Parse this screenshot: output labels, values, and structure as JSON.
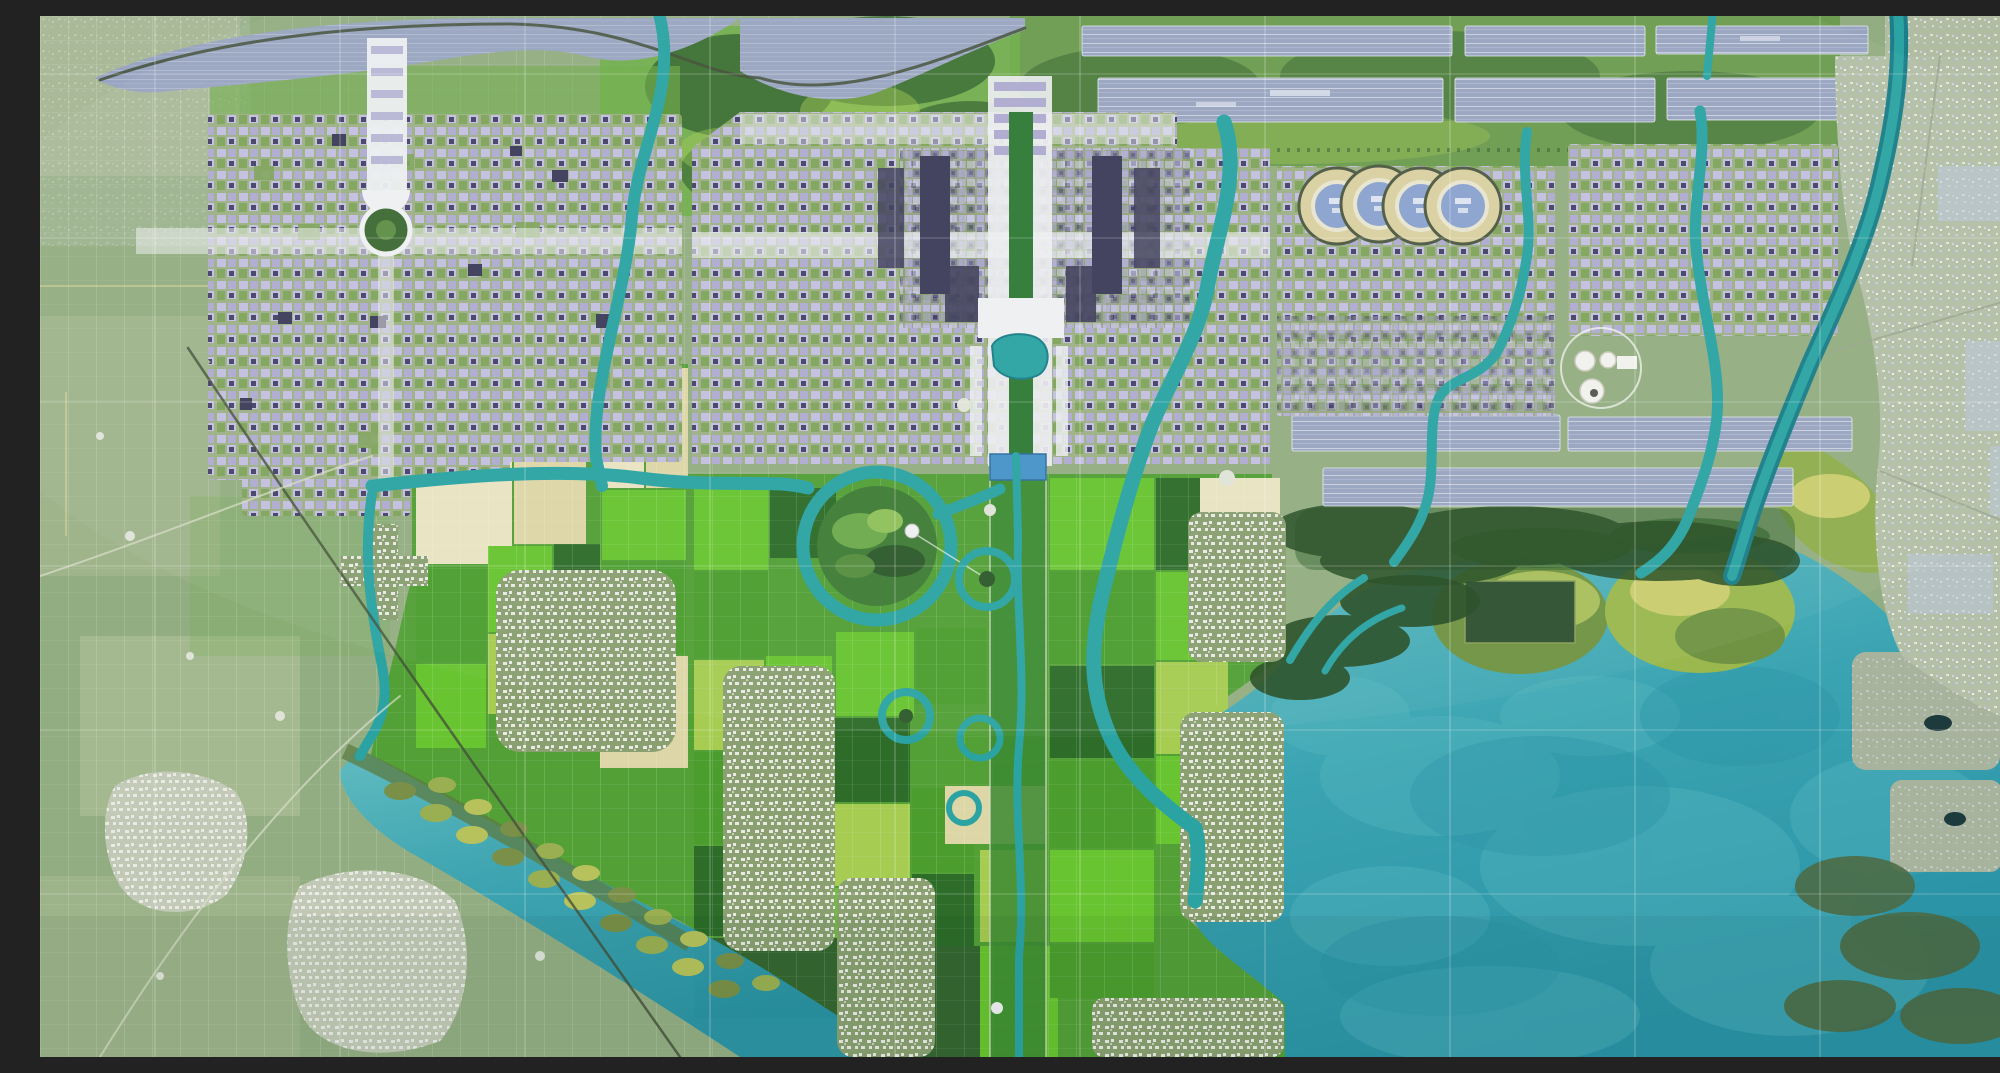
{
  "meta": {
    "title": "Aerial master-plan rendering of a planned new city with central axis, canal network, farmland mosaic and lake",
    "kind": "satellite-masterplan-image",
    "width_px": 2000,
    "height_px": 1041,
    "visible_text": "none"
  },
  "palette": {
    "base_green": "#93ad82",
    "rural_pale": "#b7c49e",
    "park_green": "#6fae49",
    "forest": "#35662f",
    "forest_dark": "#274e24",
    "marsh_olive": "#5d7c42",
    "field_bright": "#68c430",
    "field_mid": "#4b9e2e",
    "field_dark": "#2d6c29",
    "field_yellow": "#a6cc52",
    "field_tan": "#ddd6a6",
    "field_paletan": "#e9e3c2",
    "river": "#2ba3a3",
    "river_dark": "#1b7e89",
    "canal_blue": "#4693c9",
    "lake_light": "#5fbcc2",
    "lake_mid": "#3ba4b2",
    "lake_deep": "#2a93a6",
    "solar_base": "#98a4c0",
    "solar_stripe": "#c9d0e0",
    "solar_stripe2": "#aab3cb",
    "reservoir": "#9aa6c1",
    "city_base": "#9eb086",
    "city_block": "#c2bfe0",
    "city_block2": "#aeabd0",
    "city_green": "#7fa45c",
    "city_dark": "#45446a",
    "navy": "#3e3d5a",
    "axis_white": "#eef0f2",
    "village_base": "#8aa070",
    "speck_white": "#e9eae4",
    "excity_base": "#b3bfa6",
    "excity_speck": "#dfe3da",
    "excity_blue": "#bcc8da",
    "ring_band": "#d9d0a2",
    "ring_inner": "#8aa3cf",
    "tank_white": "#f1f1ee",
    "road_dark": "#43503a",
    "road_light": "#d9dec9",
    "gridline": "#ffffff"
  },
  "features": {
    "four_ring_stadiums": {
      "count": 4
    },
    "tank_facility": {
      "tank_count": 3
    },
    "axis_park_islands": {
      "count": 5
    },
    "comb_wetland_island_rows": 2,
    "north_solar_array_rows": 2,
    "east_solar_array_rows": 2
  },
  "regions": [
    {
      "id": "reservoir-canal-band",
      "name": "striped blue-gray reservoir band along the top"
    },
    {
      "id": "north-solar-arrays",
      "name": "two rows of striped solar/panel bands, top right"
    },
    {
      "id": "east-solar-arrays",
      "name": "two rows of striped solar/panel bands, mid right"
    },
    {
      "id": "northwest-city-grid",
      "name": "north-west lavender city grid with white cross axis and circular park"
    },
    {
      "id": "central-city-grid",
      "name": "central city grid with white north-south axis"
    },
    {
      "id": "axis-plaza-lake",
      "name": "white plaza and heart-shaped lake on the central axis"
    },
    {
      "id": "east-city-grid",
      "name": "city grid east of the central river"
    },
    {
      "id": "far-east-city-grid",
      "name": "far eastern city grid"
    },
    {
      "id": "four-ring-stadiums",
      "name": "four interlocking ring-shaped venues"
    },
    {
      "id": "tank-facility",
      "name": "circular utility facility with white tanks"
    },
    {
      "id": "northeast-greenbelt",
      "name": "green belt with tree rows, north-east"
    },
    {
      "id": "central-farmland-mosaic",
      "name": "bright patchwork farmland south of the city"
    },
    {
      "id": "axis-park-islands",
      "name": "ring-shaped park islands along the southern axis"
    },
    {
      "id": "big-ring-island",
      "name": "large wooded island encircled by a river"
    },
    {
      "id": "satellite-towns",
      "name": "gray satellite town clusters in the farmland"
    },
    {
      "id": "village-clusters",
      "name": "rural village patches, lower left"
    },
    {
      "id": "west-rural-farmland",
      "name": "muted rural field grid, west"
    },
    {
      "id": "comb-wetland-islands",
      "name": "diagonal comb of oval wetland islands"
    },
    {
      "id": "southeast-lake",
      "name": "large turquoise lake, south-east"
    },
    {
      "id": "lake-islands",
      "name": "yellow-green islands at the lake's north edge"
    },
    {
      "id": "lake-settlement-islands",
      "name": "gray settlement islands in the lake"
    },
    {
      "id": "east-existing-town",
      "name": "pale existing town fabric along right edge"
    },
    {
      "id": "rivers-and-canals",
      "name": "teal river and canal network"
    },
    {
      "id": "survey-grid-overlay",
      "name": "thin white survey grid lines"
    },
    {
      "id": "railway-line",
      "name": "dark diagonal railway through rural west"
    }
  ]
}
